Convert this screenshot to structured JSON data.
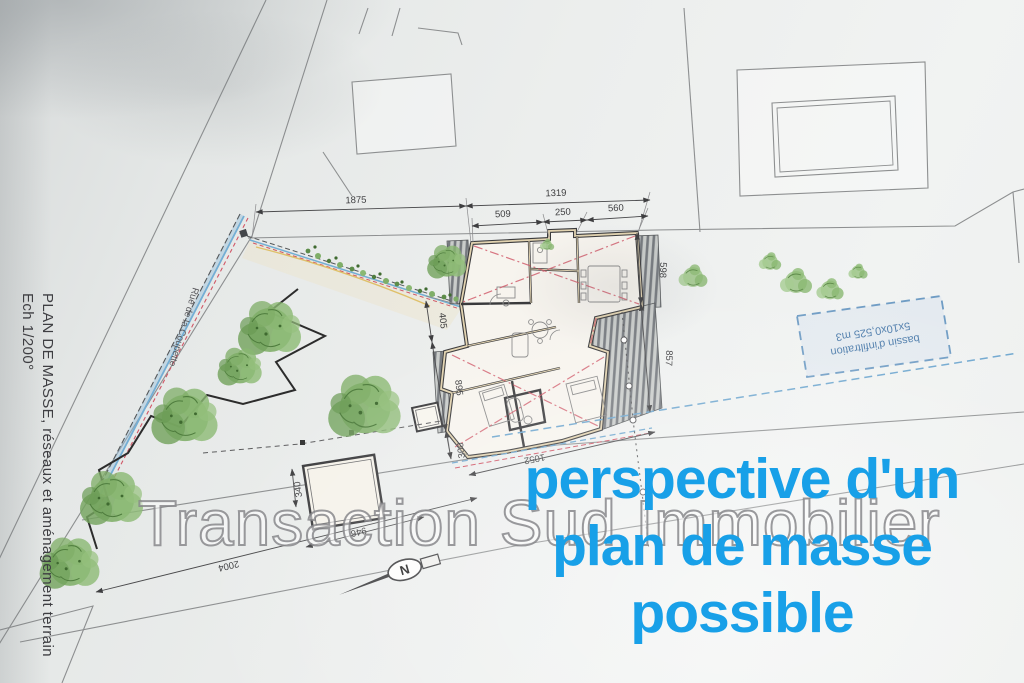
{
  "plan": {
    "title_vertical": "PLAN DE MASSE, réseaux et aménagement terrain",
    "scale_note": "Ech 1/200°",
    "street_name": "Rue de la Coupette",
    "north_label": "N",
    "bassin_label_line1": "bassin d'infiltration",
    "bassin_label_line2": "5x10x0,525 m3",
    "dims": {
      "d1875": "1875",
      "d1319": "1319",
      "d509": "509",
      "d250": "250",
      "d560": "560",
      "d598": "598",
      "d857": "857",
      "d405": "405",
      "d895": "895",
      "d300": "300",
      "d340": "340",
      "d946": "946",
      "d2004": "2004",
      "d1052": "1052"
    }
  },
  "overlay": {
    "watermark": "Transaction Sud Immobilier",
    "caption": {
      "line1": "perspective d'un",
      "line2": "plan de masse",
      "line3": "possible"
    },
    "colors": {
      "caption_blue": "#18a0e8",
      "bassin_blue": "#4d7cab",
      "utility_red": "#d05666",
      "utility_blue": "#74aed4",
      "tree_green": "#7fae68"
    }
  }
}
